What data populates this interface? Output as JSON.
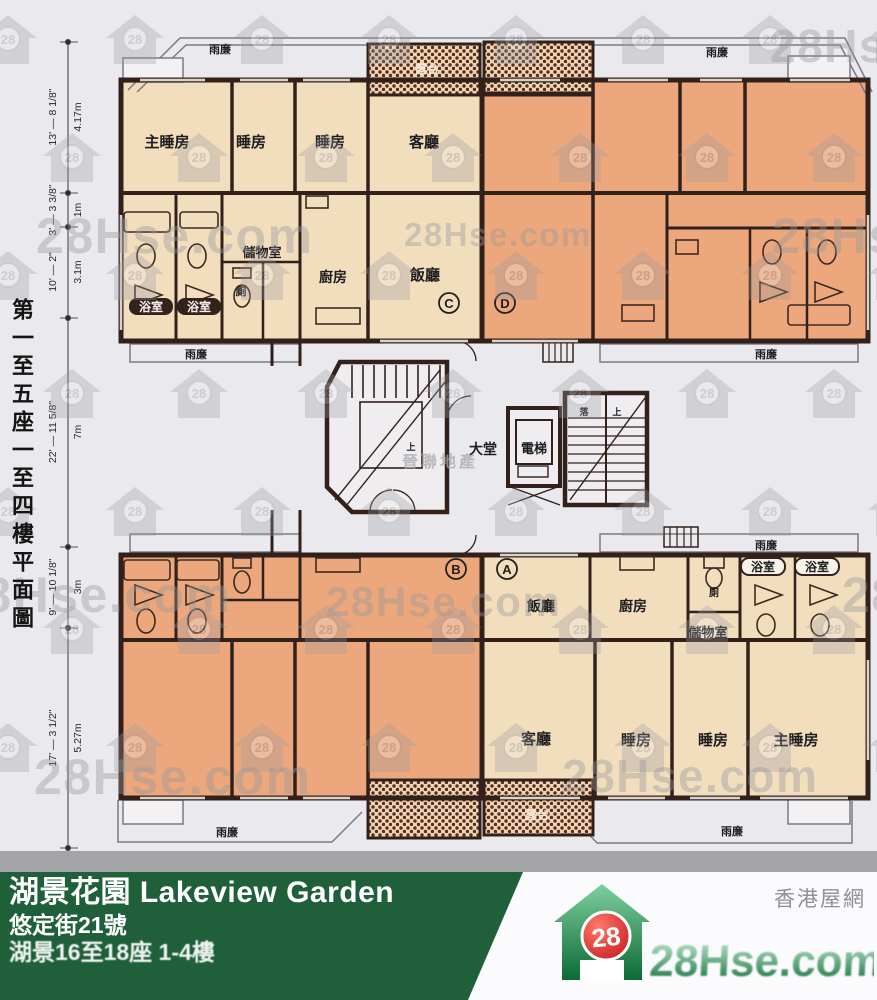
{
  "side_title": "第一至五座一至四樓平面圖",
  "watermark": {
    "site": "28Hse.com",
    "badge": "28",
    "agency": "晉聯地產"
  },
  "dimensions": [
    {
      "ft": "13' — 8 1/8\"",
      "m": "4.17m"
    },
    {
      "ft": "3' — 3 3/8\"",
      "m": "1m"
    },
    {
      "ft": "10' — 2\"",
      "m": "3.1m"
    },
    {
      "ft": "22' — 11 5/8\"",
      "m": "7m"
    },
    {
      "ft": "9' — 10 1/8\"",
      "m": "3m"
    },
    {
      "ft": "17' — 3 1/2\"",
      "m": "5.27m"
    }
  ],
  "plan": {
    "canopy": "雨廉",
    "balcony": "露台",
    "rooms": {
      "master": "主睡房",
      "bedroom": "睡房",
      "living": "客廳",
      "dining": "飯廳",
      "kitchen": "廚房",
      "bath": "浴室",
      "store": "儲物室",
      "toilet": "廁"
    },
    "core": {
      "lobby": "大堂",
      "lift": "電梯",
      "up": "上",
      "down": "落"
    },
    "units": {
      "a": "A",
      "b": "B",
      "c": "C",
      "d": "D"
    }
  },
  "footer": {
    "name": "湖景花園 Lakeview Garden",
    "address": "悠定街21號",
    "scope": "湖景16至18座 1-4樓",
    "site_label": "香港屋網",
    "logo_text": "28Hse.com",
    "logo_badge": "28"
  },
  "colors": {
    "paper": "#eae9ed",
    "unit_light": "#f2debd",
    "unit_dark": "#eca87c",
    "wall": "#32211b",
    "footer_green": "#1f5f3a",
    "logo_red": "#d0191f",
    "logo_green": "#0b6b34"
  }
}
